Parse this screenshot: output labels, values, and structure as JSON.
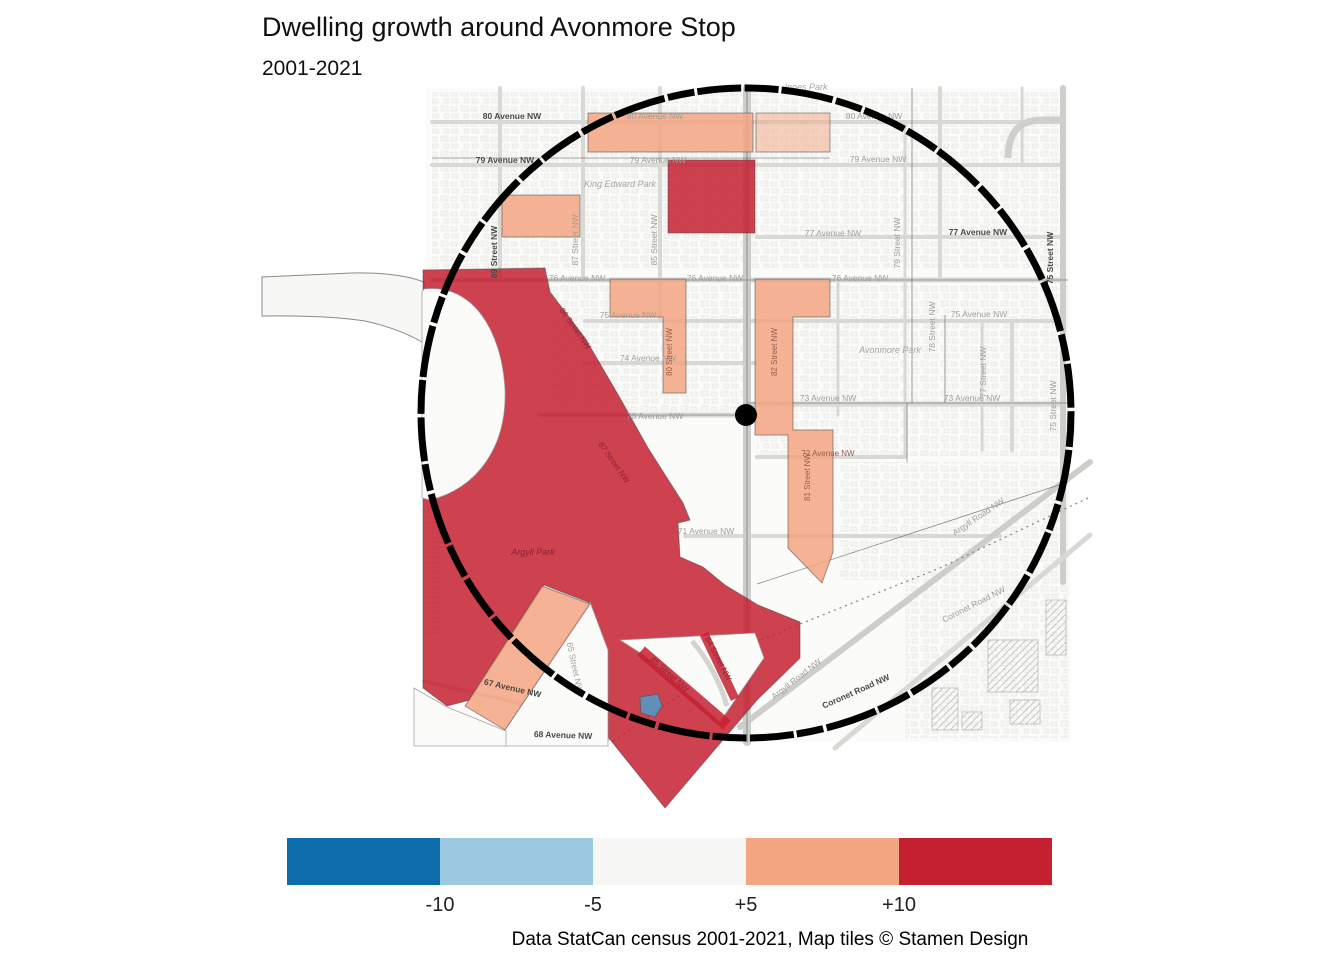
{
  "title": "Dwelling growth around Avonmore Stop",
  "subtitle": "2001-2021",
  "caption": "Data StatCan census 2001-2021, Map tiles © Stamen Design",
  "legend": {
    "swatches": [
      {
        "name": "below-minus10",
        "color": "#0D6DAD"
      },
      {
        "name": "minus10-to-minus5",
        "color": "#9CC8E0"
      },
      {
        "name": "minus5-to-plus5",
        "color": "#F6F6F5"
      },
      {
        "name": "plus5-to-plus10",
        "color": "#F4A582"
      },
      {
        "name": "above-plus10",
        "color": "#C52031"
      }
    ],
    "tick_labels": [
      "-10",
      "-5",
      "+5",
      "+10"
    ]
  },
  "chart_data": {
    "type": "choropleth_map",
    "title": "Dwelling growth around Avonmore Stop",
    "subtitle": "2001-2021",
    "scale_breaks": [
      -10,
      -5,
      5,
      10
    ],
    "scale_colors": [
      "#0D6DAD",
      "#9CC8E0",
      "#F6F6F5",
      "#F4A582",
      "#C52031"
    ],
    "buffer": {
      "shape": "circle",
      "center_label": "Avonmore Stop"
    },
    "regions": [
      {
        "area": "80 Avenue NW band",
        "class": "+5 to +10"
      },
      {
        "area": "79 Avenue / King Edward Park east block",
        "class": "above +10"
      },
      {
        "area": "King Edward Park west block",
        "class": "+5 to +10"
      },
      {
        "area": "76 Avenue NW block",
        "class": "+5 to +10"
      },
      {
        "area": "82 Street NW corridor",
        "class": "+5 to +10"
      },
      {
        "area": "Argyll Park / 87 Street NW area",
        "class": "above +10"
      },
      {
        "area": "Argyll Road SE diamond",
        "class": "above +10"
      },
      {
        "area": "67 Avenue NW wedge",
        "class": "+5 to +10"
      },
      {
        "area": "small pond polygon",
        "class": "-10 to -5"
      }
    ]
  },
  "map": {
    "palette": {
      "plus10": "#C52031",
      "plus5": "#F4A582",
      "white": "#FBFBF9",
      "pond": "#4D9DCB"
    },
    "tile_area": {
      "x": 425,
      "y": 88,
      "w": 645,
      "h": 654,
      "fill": "#FBFBF9"
    },
    "left_protrusion": {
      "d": "M262,277 L352,273 Q398,272 424,282 L424,343 Q398,328 365,321 Q325,315 262,316 Z"
    },
    "texture_blocks": [
      [
        432,
        92,
        632,
        176
      ],
      [
        757,
        284,
        311,
        172
      ],
      [
        838,
        462,
        230,
        118
      ],
      [
        545,
        284,
        198,
        130
      ],
      [
        905,
        580,
        163,
        158
      ]
    ],
    "streets": [
      [
        432,
        122,
        1064,
        122,
        4
      ],
      [
        432,
        165,
        1064,
        165,
        4
      ],
      [
        757,
        237,
        1064,
        237,
        4
      ],
      [
        432,
        280,
        1064,
        280,
        5
      ],
      [
        585,
        321,
        1064,
        321,
        4
      ],
      [
        585,
        363,
        757,
        363,
        4
      ],
      [
        540,
        415,
        747,
        415,
        5
      ],
      [
        747,
        404,
        1064,
        404,
        5
      ],
      [
        757,
        457,
        905,
        457,
        4
      ],
      [
        685,
        536,
        1000,
        536,
        4
      ],
      [
        432,
        739,
        608,
        739,
        4
      ],
      [
        500,
        88,
        500,
        280,
        4
      ],
      [
        583,
        88,
        583,
        280,
        4
      ],
      [
        660,
        88,
        660,
        321,
        4
      ],
      [
        747,
        88,
        747,
        742,
        8
      ],
      [
        838,
        280,
        838,
        415,
        3
      ],
      [
        905,
        122,
        905,
        457,
        3
      ],
      [
        940,
        88,
        940,
        280,
        4
      ],
      [
        982,
        321,
        982,
        450,
        3
      ],
      [
        1012,
        321,
        1012,
        450,
        4
      ],
      [
        1022,
        88,
        1022,
        165,
        3
      ],
      [
        1063,
        88,
        1063,
        582,
        6
      ],
      [
        1090,
        462,
        740,
        727,
        6
      ],
      [
        1090,
        535,
        835,
        748,
        5
      ],
      [
        424,
        681,
        565,
        714,
        4
      ],
      [
        566,
        645,
        600,
        742,
        4
      ]
    ],
    "ne_loop": "M1008,158 Q1008,120 1042,120 L1064,120",
    "crescent_street": "M692,641 Q716,669 727,706",
    "railway": "1088,498 940,568 760,640 612,742",
    "ct_lines": [
      [
        432,
        158,
        830,
        158
      ],
      [
        432,
        280,
        1068,
        280
      ],
      [
        540,
        415,
        747,
        415
      ],
      [
        747,
        403,
        1068,
        403
      ],
      [
        747,
        88,
        747,
        742
      ],
      [
        912,
        88,
        912,
        403
      ],
      [
        945,
        315,
        945,
        403
      ],
      [
        907,
        403,
        907,
        462
      ],
      [
        757,
        584,
        1068,
        482
      ]
    ],
    "regions": [
      {
        "name": "region-argyll-red",
        "class": "plus10",
        "pts": "423,270 545,268 550,292 585,338 620,398 648,448 683,503 690,520 678,523 680,557 703,567 725,585 758,605 800,622 800,658 757,700 665,808 608,737 608,650 588,602 544,585 470,700 447,706 423,688"
      },
      {
        "name": "ravine-white-blob",
        "class": "white",
        "d": "M424,289 C472,283 502,330 505,390 C507,448 476,489 430,500 L422,498 L422,292 Z"
      },
      {
        "name": "corridor-white",
        "class": "white",
        "pts": "590,602 608,650 608,746 504,746 504,731"
      },
      {
        "name": "below-67ave-white",
        "class": "white",
        "pts": "414,688 447,707 506,731 506,746 414,746"
      },
      {
        "name": "diamond-inner-white",
        "class": "white",
        "pts": "620,640 755,633 764,658 720,722 645,656"
      },
      {
        "name": "region-80ave-band",
        "class": "plus5",
        "pts": "588,113 753,113 753,152 588,152"
      },
      {
        "name": "region-80ave-band-east",
        "class": "plus5",
        "op": 0.5,
        "pts": "756,113 830,113 830,152 756,152"
      },
      {
        "name": "region-king-edward-west",
        "class": "plus5",
        "pts": "502,195 580,195 580,237 502,237"
      },
      {
        "name": "region-76ave-L",
        "class": "plus5",
        "pts": "610,279 686,279 686,393 663,393 663,317 610,317"
      },
      {
        "name": "region-82st-corridor",
        "class": "plus5",
        "pts": "755,279 830,279 830,317 793,317 793,430 833,430 833,552 822,583 788,548 788,435 755,435"
      },
      {
        "name": "region-67ave-wedge",
        "class": "plus5",
        "pts": "542,586 590,604 505,730 465,706"
      },
      {
        "name": "region-79ave-red",
        "class": "plus10",
        "pts": "668,160 755,160 755,233 668,233"
      },
      {
        "name": "region-pond",
        "class": "pond",
        "pts": "640,697 658,694 662,706 655,717 641,713"
      }
    ],
    "red_bands": [
      [
        641,
        651,
        727,
        725,
        12
      ],
      [
        704,
        634,
        735,
        699,
        9
      ]
    ],
    "hatches": [
      [
        988,
        640,
        50,
        52
      ],
      [
        1046,
        600,
        20,
        55
      ],
      [
        932,
        688,
        26,
        42
      ],
      [
        1010,
        700,
        30,
        24
      ],
      [
        962,
        712,
        20,
        18
      ]
    ],
    "labels": [
      {
        "t": "80 Avenue NW",
        "x": 512,
        "y": 119,
        "r": 0,
        "s": "bold"
      },
      {
        "t": "80 Avenue NW",
        "x": 655,
        "y": 119,
        "r": 0,
        "s": "gray"
      },
      {
        "t": "80 Avenue NW",
        "x": 874,
        "y": 119,
        "r": 0,
        "s": "gray"
      },
      {
        "t": "79 Avenue NW",
        "x": 505,
        "y": 163,
        "r": 0,
        "s": "bold"
      },
      {
        "t": "79 Avenue NW",
        "x": 658,
        "y": 163,
        "r": 0,
        "s": "gray"
      },
      {
        "t": "79 Avenue NW",
        "x": 878,
        "y": 162,
        "r": 0,
        "s": "gray"
      },
      {
        "t": "77 Avenue NW",
        "x": 833,
        "y": 236,
        "r": 0,
        "s": "gray"
      },
      {
        "t": "77 Avenue NW",
        "x": 978,
        "y": 235,
        "r": 0,
        "s": "bold"
      },
      {
        "t": "76 Avenue NW",
        "x": 577,
        "y": 281,
        "r": 0,
        "s": "gray"
      },
      {
        "t": "76 Avenue NW",
        "x": 715,
        "y": 281,
        "r": 0,
        "s": "gray"
      },
      {
        "t": "76 Avenue NW",
        "x": 860,
        "y": 281,
        "r": 0,
        "s": "gray"
      },
      {
        "t": "75 Avenue NW",
        "x": 628,
        "y": 318,
        "r": 0,
        "s": "gray"
      },
      {
        "t": "75 Avenue NW",
        "x": 979,
        "y": 317,
        "r": 0,
        "s": "gray"
      },
      {
        "t": "74 Avenue NW",
        "x": 648,
        "y": 361,
        "r": 0,
        "s": "gray"
      },
      {
        "t": "73 Avenue NW",
        "x": 655,
        "y": 419,
        "r": 0,
        "s": "gray"
      },
      {
        "t": "73 Avenue NW",
        "x": 828,
        "y": 401,
        "r": 0,
        "s": "gray"
      },
      {
        "t": "73 Avenue NW",
        "x": 972,
        "y": 401,
        "r": 0,
        "s": "gray"
      },
      {
        "t": "72 Avenue NW",
        "x": 828,
        "y": 456,
        "r": 0,
        "s": "onor"
      },
      {
        "t": "71 Avenue NW",
        "x": 706,
        "y": 534,
        "r": 0,
        "s": "gray"
      },
      {
        "t": "89 Street NW",
        "x": 497,
        "y": 252,
        "r": -90,
        "s": "bold"
      },
      {
        "t": "87 Street NW",
        "x": 578,
        "y": 240,
        "r": -90,
        "s": "gray"
      },
      {
        "t": "85 Street NW",
        "x": 657,
        "y": 240,
        "r": -90,
        "s": "gray"
      },
      {
        "t": "80 Street NW",
        "x": 672,
        "y": 352,
        "r": -90,
        "s": "onor"
      },
      {
        "t": "82 Street NW",
        "x": 777,
        "y": 352,
        "r": -90,
        "s": "onor"
      },
      {
        "t": "81 Street NW",
        "x": 810,
        "y": 477,
        "r": -90,
        "s": "onor"
      },
      {
        "t": "79 Street NW",
        "x": 900,
        "y": 243,
        "r": -90,
        "s": "gray"
      },
      {
        "t": "78 Street NW",
        "x": 935,
        "y": 327,
        "r": -90,
        "s": "gray"
      },
      {
        "t": "77 Street NW",
        "x": 986,
        "y": 372,
        "r": -90,
        "s": "gray"
      },
      {
        "t": "75 Street NW",
        "x": 1053,
        "y": 258,
        "r": -90,
        "s": "bold"
      },
      {
        "t": "75 Street NW",
        "x": 1056,
        "y": 406,
        "r": -90,
        "s": "gray"
      },
      {
        "t": "86 Street NW",
        "x": 573,
        "y": 330,
        "r": 55,
        "s": "red"
      },
      {
        "t": "87 Street NW",
        "x": 612,
        "y": 464,
        "r": 55,
        "s": "red"
      },
      {
        "t": "85 Street NW",
        "x": 668,
        "y": 676,
        "r": 42,
        "s": "red"
      },
      {
        "t": "84 Street NW",
        "x": 716,
        "y": 660,
        "r": 62,
        "s": "red"
      },
      {
        "t": "65 Street NW",
        "x": 572,
        "y": 668,
        "r": 78,
        "s": "gray"
      },
      {
        "t": "67 Avenue NW",
        "x": 512,
        "y": 691,
        "r": 13,
        "s": "bold"
      },
      {
        "t": "68 Avenue NW",
        "x": 563,
        "y": 738,
        "r": 2,
        "s": "bold"
      },
      {
        "t": "Argyll Road NW",
        "x": 980,
        "y": 519,
        "r": -34,
        "s": "gray"
      },
      {
        "t": "Argyll Road NW",
        "x": 798,
        "y": 681,
        "r": -38,
        "s": "gray"
      },
      {
        "t": "Coronet Road NW",
        "x": 975,
        "y": 607,
        "r": -27,
        "s": "gray"
      },
      {
        "t": "Coronet Road NW",
        "x": 857,
        "y": 694,
        "r": -24,
        "s": "bold"
      },
      {
        "t": "King Edward Park",
        "x": 620,
        "y": 187,
        "r": 0,
        "s": "park"
      },
      {
        "t": "Avonmore Park",
        "x": 890,
        "y": 353,
        "r": 0,
        "s": "park"
      },
      {
        "t": "Argyll Park",
        "x": 533,
        "y": 555,
        "r": 0,
        "s": "redpark"
      },
      {
        "t": "Innes Park",
        "x": 806,
        "y": 90,
        "r": 0,
        "s": "park"
      }
    ],
    "label_styles": {
      "gray": {
        "fill": "#a0a09c",
        "size": 8.5,
        "weight": 400,
        "style": "normal"
      },
      "bold": {
        "fill": "#4a4a48",
        "size": 8.5,
        "weight": 700,
        "style": "normal"
      },
      "red": {
        "fill": "#8E2236",
        "size": 8,
        "weight": 400,
        "style": "normal"
      },
      "onor": {
        "fill": "#95604f",
        "size": 8,
        "weight": 400,
        "style": "normal"
      },
      "park": {
        "fill": "#a8a8a2",
        "size": 9,
        "weight": 400,
        "style": "italic"
      },
      "redpark": {
        "fill": "#8E2236",
        "size": 9,
        "weight": 400,
        "style": "italic"
      }
    },
    "buffer_circle": {
      "cx": 746,
      "cy": 413,
      "r": 325
    },
    "stop_point": {
      "cx": 746,
      "cy": 415,
      "r": 11
    }
  }
}
